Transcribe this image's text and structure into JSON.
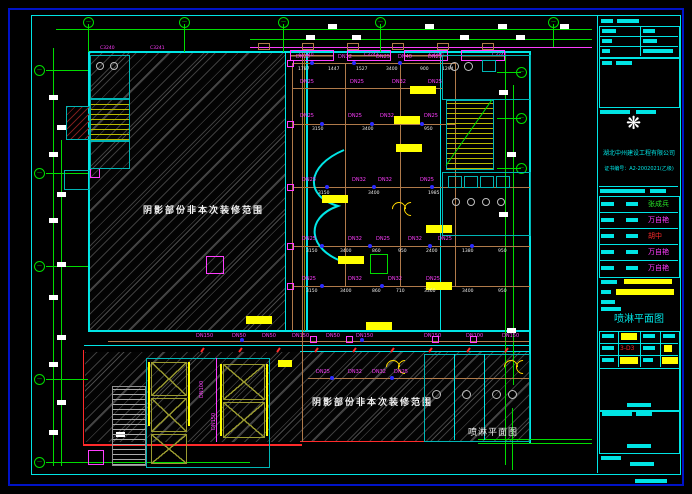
{
  "colors": {
    "frame_blue": "#0013C8",
    "frame_cyan": "#00E5E5",
    "axis_green": "#00DC00",
    "label_magenta": "#FF3DFF",
    "pipe_tan": "#B07A4A",
    "highlight_yellow": "#FFFF00",
    "sprinkler_blue": "#2B2BFF",
    "alert_red": "#FF2A2A"
  },
  "plan": {
    "region_note": "阴影部份非本次装修范围",
    "plan_label": "喷淋平面图",
    "axis_glyph": "—",
    "window_labels": [
      "C3240",
      "C3241",
      "C3240",
      "C3241",
      "C3240",
      "C3241"
    ],
    "pipe_labels": {
      "rowA": [
        "DN25",
        "DN32",
        "DN25",
        "DN40",
        "DN25"
      ],
      "rowB": [
        "DN25",
        "DN25",
        "DN32",
        "DN25"
      ],
      "rowC": [
        "DN25",
        "DN25",
        "DN32",
        "DN25"
      ],
      "rowD": [
        "DN25",
        "DN32",
        "DN32",
        "DN25"
      ],
      "rowE": [
        "DN25",
        "DN32",
        "DN25",
        "DN32",
        "DN25"
      ],
      "rowF": [
        "DN25",
        "DN32",
        "DN32",
        "DN25"
      ],
      "rowG": [
        "DN150",
        "DN50",
        "DN50",
        "DN150",
        "DN50",
        "DN150",
        "DN150",
        "DN100",
        "DN150"
      ],
      "rowH": [
        "DN25",
        "DN32",
        "DN32",
        "DN25"
      ],
      "risers": [
        "DN100",
        "DN150"
      ]
    },
    "dims": {
      "rowA": [
        "1787",
        "1447",
        "1527",
        "3400",
        "900",
        "1294"
      ],
      "rowC": [
        "3150",
        "3400",
        "950"
      ],
      "rowD": [
        "3150",
        "3400",
        "1985"
      ],
      "rowE": [
        "3150",
        "3400",
        "860",
        "950",
        "2400",
        "1380",
        "950"
      ],
      "rowF": [
        "3150",
        "3400",
        "860",
        "710",
        "3360",
        "3400",
        "950"
      ]
    }
  },
  "title_block": {
    "company": "湖北中州建设工程有限公司",
    "certificate": "证书编号：A2-2002021(乙级)",
    "drawing_title": "喷淋平面图",
    "drawing_no": "3-D3",
    "signatures": [
      "张成兵",
      "万自艳",
      "胡中",
      "万自艳",
      "万自艳"
    ]
  }
}
